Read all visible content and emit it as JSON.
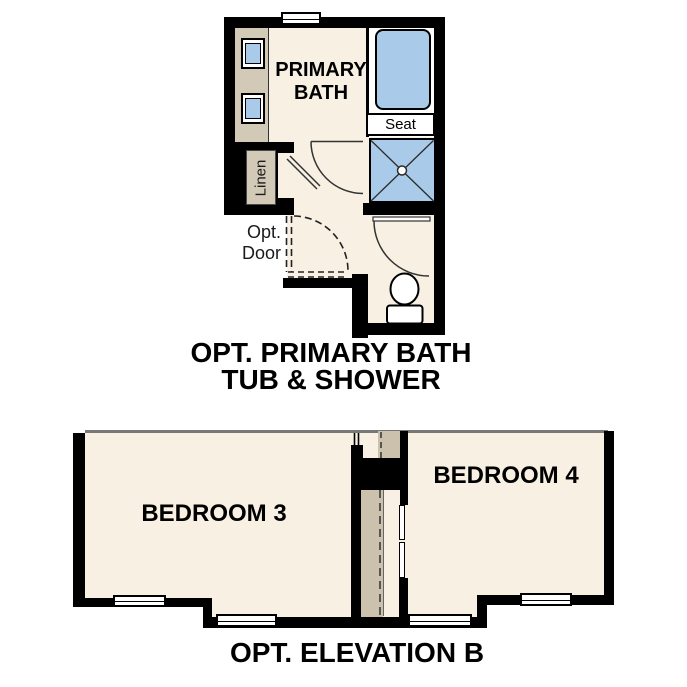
{
  "floor_plan_upper": {
    "room_label_line1": "PRIMARY",
    "room_label_line2": "BATH",
    "seat_label": "Seat",
    "linen_label": "Linen",
    "opt_door_label_line1": "Opt.",
    "opt_door_label_line2": "Door",
    "caption_line1": "OPT. PRIMARY BATH",
    "caption_line2": "TUB & SHOWER"
  },
  "floor_plan_lower": {
    "bedroom3_label": "BEDROOM 3",
    "bedroom4_label": "BEDROOM 4",
    "caption": "OPT. ELEVATION B"
  },
  "colors": {
    "wall": "#000000",
    "floor": "#F7F0E3",
    "cabinetry_tan": "#D3C9B7",
    "stair_tan": "#CBC1AD",
    "fixture_blue": "#A9CBE9",
    "linework": "#333333",
    "text": "#000000"
  }
}
